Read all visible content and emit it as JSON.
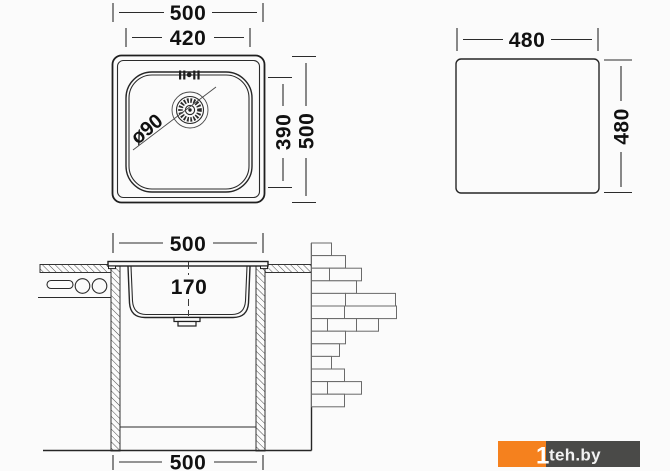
{
  "views": {
    "top": {
      "outer_width": "500",
      "inner_width": "420",
      "inner_height": "390",
      "outer_height": "500",
      "drain_diameter": "ø90"
    },
    "cutout": {
      "width": "480",
      "height": "480"
    },
    "section": {
      "top_width": "500",
      "depth": "170",
      "bottom_width": "500"
    }
  },
  "watermark": {
    "digit": "1",
    "site": "teh.by"
  },
  "colors": {
    "line": "#222222",
    "brick_line": "#6a6a6a",
    "watermark_orange": "#f5811e",
    "watermark_gray": "#4a4a48",
    "background": "#fbfbfb"
  }
}
